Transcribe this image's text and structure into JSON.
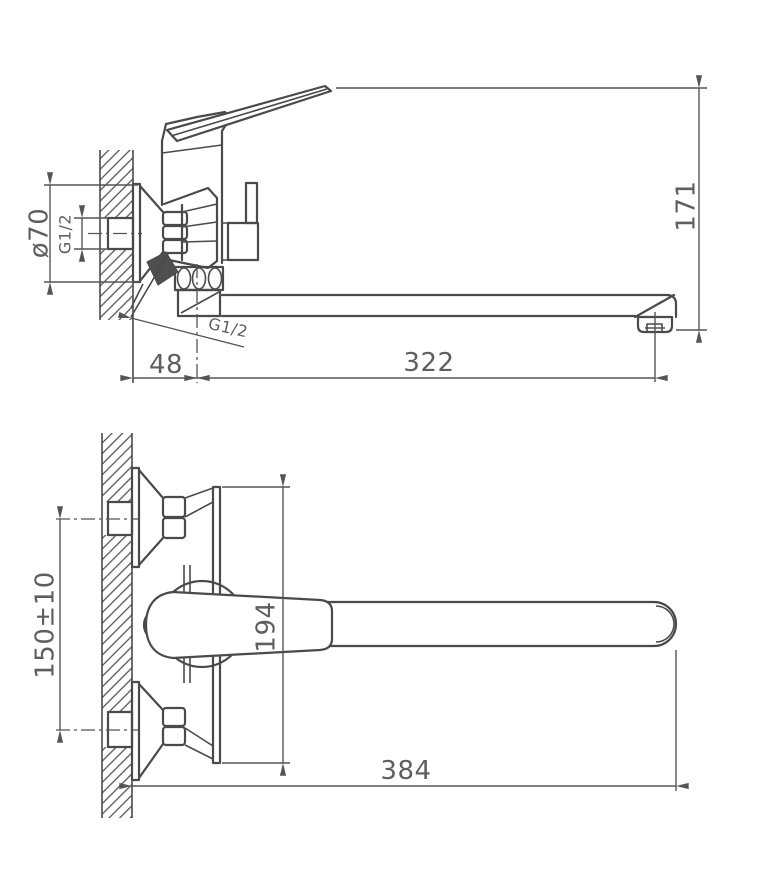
{
  "drawing": {
    "type": "technical-drawing",
    "subject": "Wall-mounted single-lever bath mixer faucet, two orthographic views with dimensions",
    "colors": {
      "background": "#ffffff",
      "lines": "#4a4a4a",
      "text": "#5f5f5f"
    },
    "side_view": {
      "name": "side view (section at wall)",
      "dimensions": [
        {
          "id": "flange-diameter",
          "label": "ø70"
        },
        {
          "id": "inlet-thread",
          "label": "G1/2"
        },
        {
          "id": "wall-to-body-center",
          "label": "48"
        },
        {
          "id": "spout-thread",
          "label": "G1/2"
        },
        {
          "id": "center-to-spout-outlet",
          "label": "322"
        },
        {
          "id": "overall-height",
          "label": "171"
        }
      ]
    },
    "front_view": {
      "name": "front view",
      "dimensions": [
        {
          "id": "inlet-centers",
          "label": "150±10"
        },
        {
          "id": "body-height",
          "label": "194"
        },
        {
          "id": "overall-length",
          "label": "384"
        }
      ]
    }
  }
}
